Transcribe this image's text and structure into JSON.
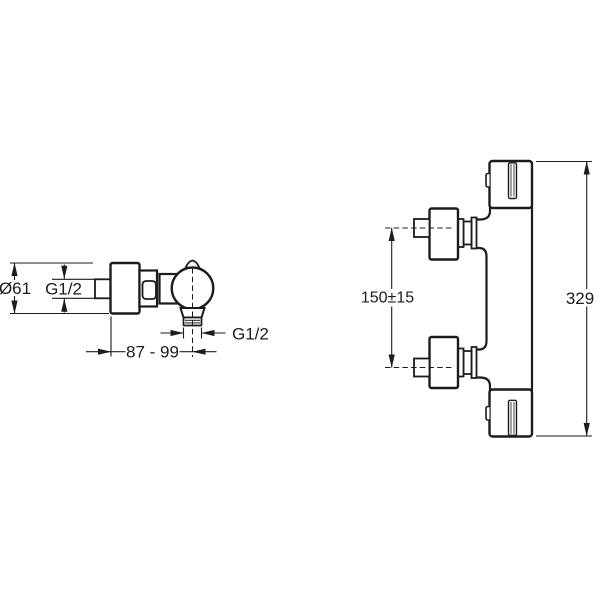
{
  "colors": {
    "background": "#ffffff",
    "line": "#1c1c1c"
  },
  "side_view": {
    "diameter": "Ø61",
    "inlet_thread": "G1/2",
    "outlet_thread": "G1/2",
    "wall_distance": "87 - 99"
  },
  "front_view": {
    "inlet_spacing": "150±15",
    "overall_height": "329"
  }
}
